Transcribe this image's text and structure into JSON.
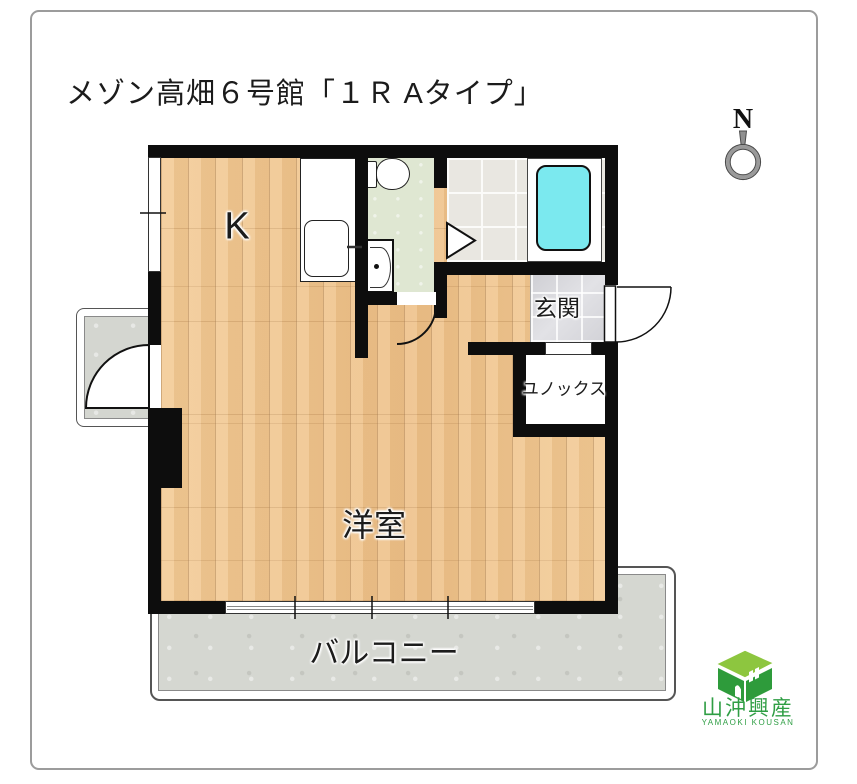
{
  "title": "メゾン高畑６号館「１Ｒ Aタイプ」",
  "compass": {
    "north_label": "N"
  },
  "floor_plan": {
    "rooms": [
      {
        "id": "kitchen",
        "label": "K"
      },
      {
        "id": "entrance",
        "label": "玄関"
      },
      {
        "id": "closet",
        "label": "ユノックス"
      },
      {
        "id": "western_room",
        "label": "洋室"
      },
      {
        "id": "balcony",
        "label": "バルコニー"
      }
    ],
    "fixtures": [
      "kitchen-counter-with-sink",
      "toilet",
      "washbasin",
      "bathtub",
      "bathroom-folding-door",
      "entrance-hinged-door",
      "washroom-hinged-door",
      "alcove-hinged-door",
      "sliding-window",
      "wall-window"
    ],
    "colors": {
      "wall": "#0d0d0d",
      "wood_floor": "#f0c692",
      "washroom_floor": "#dfe7d2",
      "bath_tile": "#e9e7e1",
      "entrance_tile": "#d7d7da",
      "concrete": "#d5d7d1",
      "bathtub": "#7be9ef",
      "logo_green": "#2f9e44"
    }
  },
  "logo": {
    "company_kanji": "山沖興産",
    "company_romaji": "YAMAOKI KOUSAN"
  }
}
